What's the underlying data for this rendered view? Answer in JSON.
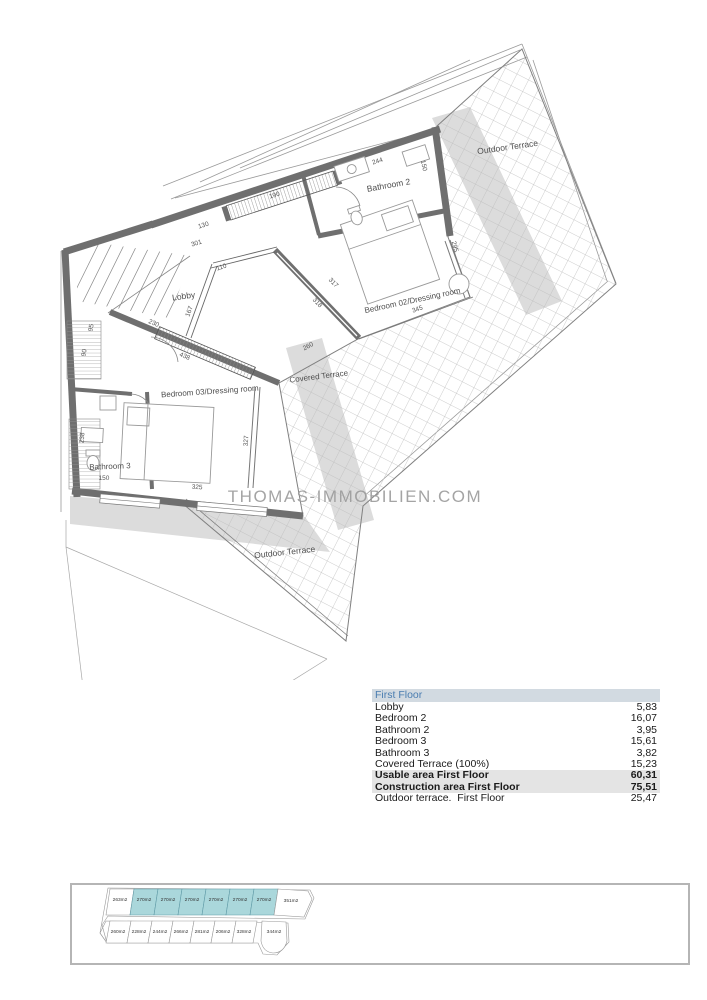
{
  "watermark": "THOMAS-IMMOBILIEN.COM",
  "floor_plan": {
    "room_labels": {
      "outdoor_terrace_top": "Outdoor Terrace",
      "bathroom_2": "Bathroom 2",
      "lobby": "Lobby",
      "bedroom_02": "Bedroom 02/Dressing room",
      "covered_terrace": "Covered Terrace",
      "bedroom_03": "Bedroom 03/Dressing room",
      "bathroom_3": "Bathroom 3",
      "outdoor_terrace_bottom": "Outdoor Terrace"
    },
    "dimensions": [
      "244",
      "150",
      "190",
      "130",
      "301",
      "110",
      "167",
      "230",
      "438",
      "95",
      "90",
      "238",
      "150",
      "325",
      "327",
      "317",
      "318",
      "260",
      "345",
      "295"
    ]
  },
  "area_table": {
    "header": "First Floor",
    "rows": [
      {
        "label": "Lobby",
        "value": "5,83"
      },
      {
        "label": "Bedroom 2",
        "value": "16,07"
      },
      {
        "label": "Bathroom 2",
        "value": "3,95"
      },
      {
        "label": "Bedroom 3",
        "value": "15,61"
      },
      {
        "label": "Bathroom 3",
        "value": "3,82"
      },
      {
        "label": "Covered Terrace (100%)",
        "value": "15,23"
      },
      {
        "label": "Usable area First Floor",
        "value": "60,31"
      },
      {
        "label": "Construction area First Floor",
        "value": "75,51"
      },
      {
        "label": "Outdoor terrace.  First Floor",
        "value": "25,47"
      }
    ]
  },
  "site_plan": {
    "top_row": [
      "263m2",
      "270m2",
      "270m2",
      "270m2",
      "270m2",
      "270m2",
      "270m2",
      "351m2"
    ],
    "bottom_row": [
      "260m2",
      "228m2",
      "244m2",
      "266m2",
      "281m2",
      "206m2",
      "328m2",
      "344m2"
    ],
    "highlight_color": "#aad7db"
  },
  "colors": {
    "wall": "#6f6f6f",
    "hatch": "#bdbdbd",
    "shadow": "#dcdcdc",
    "table_header_bg": "#d2dae1",
    "table_header_text": "#4a7db0",
    "table_subtotal_bg": "#e4e4e4"
  }
}
